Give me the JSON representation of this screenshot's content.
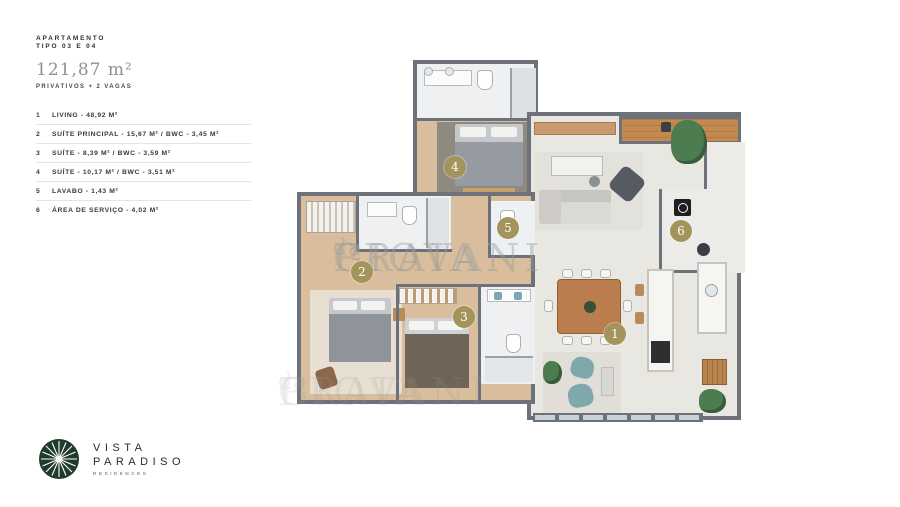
{
  "header": {
    "label_line1": "APARTAMENTO",
    "label_line2": "TIPO 03 E 04",
    "area": "121,87 m²",
    "subtitle": "PRIVATIVOS + 2 VAGAS"
  },
  "legend": {
    "items": [
      {
        "num": "1",
        "label": "LIVING - 48,92 M²"
      },
      {
        "num": "2",
        "label": "SUÍTE PRINCIPAL - 15,67 M² / BWC - 3,45 M²"
      },
      {
        "num": "3",
        "label": "SUÍTE - 8,39 M² / BWC - 3,59 M²"
      },
      {
        "num": "4",
        "label": "SUÍTE - 10,17 M² / BWC - 3,51 M²"
      },
      {
        "num": "5",
        "label": "LAVABO - 1,43 M²"
      },
      {
        "num": "6",
        "label": "ÁREA DE SERVIÇO - 4,02 M²"
      }
    ]
  },
  "logo": {
    "name_line1": "VISTA",
    "name_line2": "PARADISO",
    "subtitle": "RESIDENCES"
  },
  "plan": {
    "watermark": {
      "part1": "GIOVANI",
      "part2": "da",
      "part3": "PRAIA"
    },
    "markers": [
      {
        "num": "1",
        "room": "living"
      },
      {
        "num": "2",
        "room": "suite-principal"
      },
      {
        "num": "3",
        "room": "suite-3"
      },
      {
        "num": "4",
        "room": "suite-4"
      },
      {
        "num": "5",
        "room": "lavabo"
      },
      {
        "num": "6",
        "room": "area-de-servico"
      }
    ]
  },
  "colors": {
    "marker_gold": "#a3945c",
    "logo_green": "#1f3b2c",
    "wall_gray": "#6d727a",
    "wood_floor": "#d9bd9c",
    "balcony_wood": "#c4894f",
    "tile_light": "#eef0f2",
    "floor_light": "#e9e7e2",
    "accent_teal": "#7fa8ad",
    "plant_green": "#4d7c50"
  }
}
